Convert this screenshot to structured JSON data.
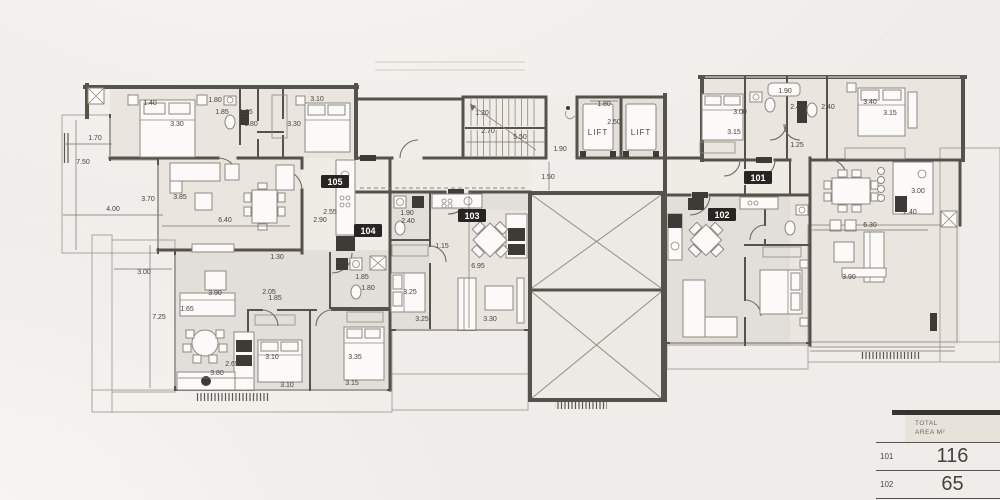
{
  "colors": {
    "background": "#efede9",
    "wall": "#55514b",
    "dim_text": "#47443e",
    "badge_bg": "#262522",
    "badge_text": "#ffffff",
    "floor_a": "#eae6df",
    "floor_b": "#e2dfda",
    "deck": "#d8d1c8",
    "deck_line": "#bdb4a9",
    "green": "#cdd7c0",
    "green_dot": "#8da37c",
    "void_fill": "#eceae4",
    "table_bar": "#35332f",
    "table_header_bg": "#e8e3da",
    "table_text": "#4c4944"
  },
  "plan": {
    "unit_badges": [
      {
        "label": "105",
        "x": 335,
        "y": 182
      },
      {
        "label": "104",
        "x": 368,
        "y": 231
      },
      {
        "label": "103",
        "x": 472,
        "y": 216
      },
      {
        "label": "102",
        "x": 722,
        "y": 215
      },
      {
        "label": "101",
        "x": 758,
        "y": 178
      }
    ],
    "lift_labels": [
      {
        "label": "LIFT",
        "x": 598,
        "y": 135
      },
      {
        "label": "LIFT",
        "x": 641,
        "y": 135
      }
    ],
    "dimensions": [
      {
        "v": "1.70",
        "x": 95,
        "y": 140
      },
      {
        "v": "7.50",
        "x": 83,
        "y": 164
      },
      {
        "v": "3.70",
        "x": 148,
        "y": 201
      },
      {
        "v": "4.00",
        "x": 113,
        "y": 211
      },
      {
        "v": "1.40",
        "x": 150,
        "y": 105
      },
      {
        "v": "3.30",
        "x": 177,
        "y": 126
      },
      {
        "v": "1.80",
        "x": 215,
        "y": 102
      },
      {
        "v": "1.85",
        "x": 222,
        "y": 114
      },
      {
        "v": "1.85",
        "x": 246,
        "y": 114
      },
      {
        "v": "1.80",
        "x": 251,
        "y": 126
      },
      {
        "v": "3.85",
        "x": 180,
        "y": 199
      },
      {
        "v": "6.40",
        "x": 225,
        "y": 222
      },
      {
        "v": "3.10",
        "x": 317,
        "y": 101
      },
      {
        "v": "3.30",
        "x": 294,
        "y": 126
      },
      {
        "v": "2.55",
        "x": 330,
        "y": 214
      },
      {
        "v": "2.90",
        "x": 320,
        "y": 222
      },
      {
        "v": "1.20",
        "x": 482,
        "y": 115
      },
      {
        "v": "2.70",
        "x": 488,
        "y": 133
      },
      {
        "v": "5.50",
        "x": 520,
        "y": 139
      },
      {
        "v": "1.90",
        "x": 560,
        "y": 151
      },
      {
        "v": "1.50",
        "x": 548,
        "y": 179
      },
      {
        "v": "1.80",
        "x": 604,
        "y": 106
      },
      {
        "v": "2.50",
        "x": 614,
        "y": 124
      },
      {
        "v": "1.30",
        "x": 277,
        "y": 259
      },
      {
        "v": "3.00",
        "x": 144,
        "y": 274
      },
      {
        "v": "7.25",
        "x": 159,
        "y": 319
      },
      {
        "v": "3.90",
        "x": 215,
        "y": 295
      },
      {
        "v": "1.65",
        "x": 187,
        "y": 311
      },
      {
        "v": "2.05",
        "x": 269,
        "y": 294
      },
      {
        "v": "1.85",
        "x": 275,
        "y": 300
      },
      {
        "v": "2.65",
        "x": 232,
        "y": 366
      },
      {
        "v": "3.80",
        "x": 217,
        "y": 375
      },
      {
        "v": "3.10",
        "x": 272,
        "y": 359
      },
      {
        "v": "3.10",
        "x": 287,
        "y": 387
      },
      {
        "v": "3.35",
        "x": 355,
        "y": 359
      },
      {
        "v": "3.15",
        "x": 352,
        "y": 385
      },
      {
        "v": "1.85",
        "x": 362,
        "y": 279
      },
      {
        "v": "1.80",
        "x": 368,
        "y": 290
      },
      {
        "v": "1.90",
        "x": 407,
        "y": 215
      },
      {
        "v": "2.40",
        "x": 408,
        "y": 223
      },
      {
        "v": "1.15",
        "x": 442,
        "y": 248
      },
      {
        "v": "6.95",
        "x": 478,
        "y": 268
      },
      {
        "v": "3.25",
        "x": 410,
        "y": 294
      },
      {
        "v": "3.25",
        "x": 422,
        "y": 321
      },
      {
        "v": "3.30",
        "x": 490,
        "y": 321
      },
      {
        "v": "1.90",
        "x": 785,
        "y": 93
      },
      {
        "v": "3.00",
        "x": 740,
        "y": 114
      },
      {
        "v": "2.40",
        "x": 797,
        "y": 109
      },
      {
        "v": "2.40",
        "x": 828,
        "y": 109
      },
      {
        "v": "3.40",
        "x": 870,
        "y": 104
      },
      {
        "v": "3.15",
        "x": 890,
        "y": 115
      },
      {
        "v": "3.15",
        "x": 734,
        "y": 134
      },
      {
        "v": "1.25",
        "x": 797,
        "y": 147
      },
      {
        "v": "3.00",
        "x": 918,
        "y": 193
      },
      {
        "v": "2.40",
        "x": 910,
        "y": 214
      },
      {
        "v": "6.30",
        "x": 870,
        "y": 227
      },
      {
        "v": "3.90",
        "x": 849,
        "y": 279
      }
    ]
  },
  "area_table": {
    "header_line1": "TOTAL",
    "header_line2": "AREA M²",
    "rows": [
      {
        "unit": "101",
        "value": "116"
      },
      {
        "unit": "102",
        "value": "65"
      }
    ]
  }
}
